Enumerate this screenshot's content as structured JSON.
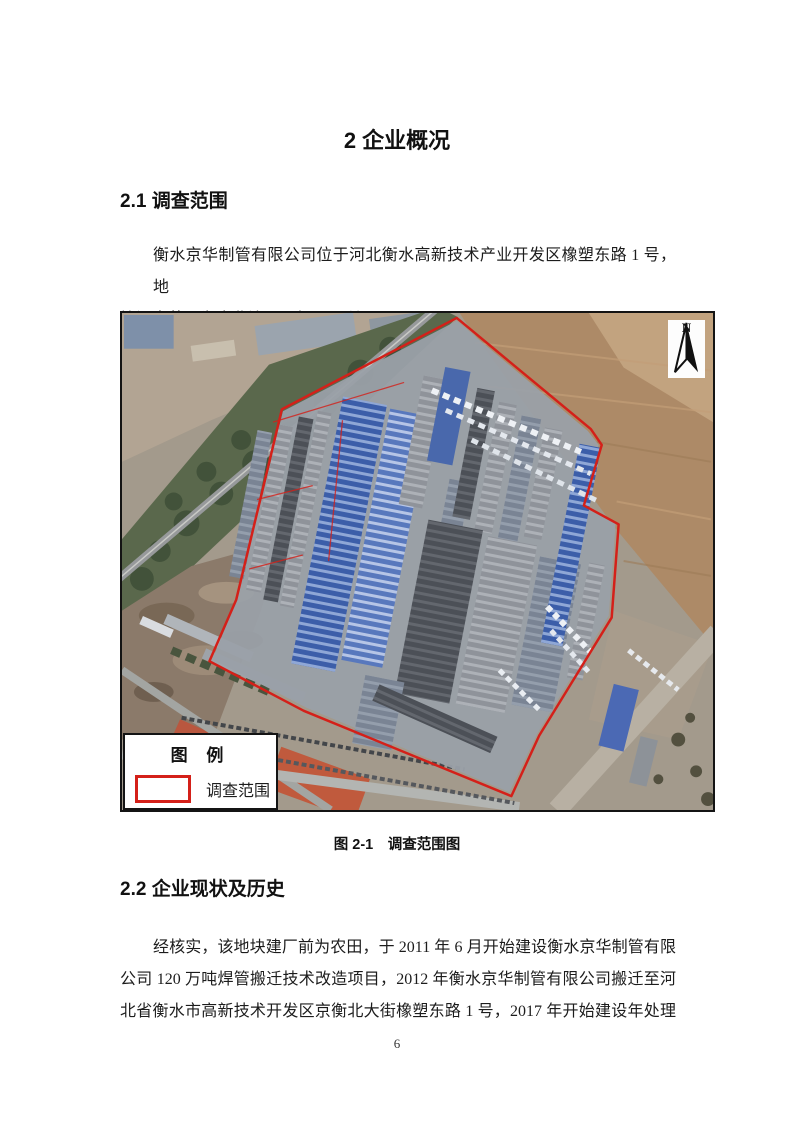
{
  "title": "2 企业概况",
  "sections": {
    "s21": {
      "heading": "2.1 调查范围",
      "para_lines": [
        "衡水京华制管有限公司位于河北衡水高新技术产业开发区橡塑东路 1 号，地",
        "块调查范围为企业边界，如下图所示。"
      ]
    },
    "s22": {
      "heading": "2.2 企业现状及历史",
      "para_lines": [
        "经核实，该地块建厂前为农田，于 2011 年 6 月开始建设衡水京华制管有限",
        "公司 120 万吨焊管搬迁技术改造项目，2012 年衡水京华制管有限公司搬迁至河",
        "北省衡水市高新技术开发区京衡北大街橡塑东路 1 号，2017 年开始建设年处理"
      ]
    }
  },
  "figure": {
    "caption": "图 2-1　调查范围图",
    "legend": {
      "title": "图 例",
      "item_label": "调查范围"
    },
    "north_label": "N"
  },
  "colors": {
    "survey_boundary": "#d42019"
  },
  "page": {
    "number": "6"
  }
}
